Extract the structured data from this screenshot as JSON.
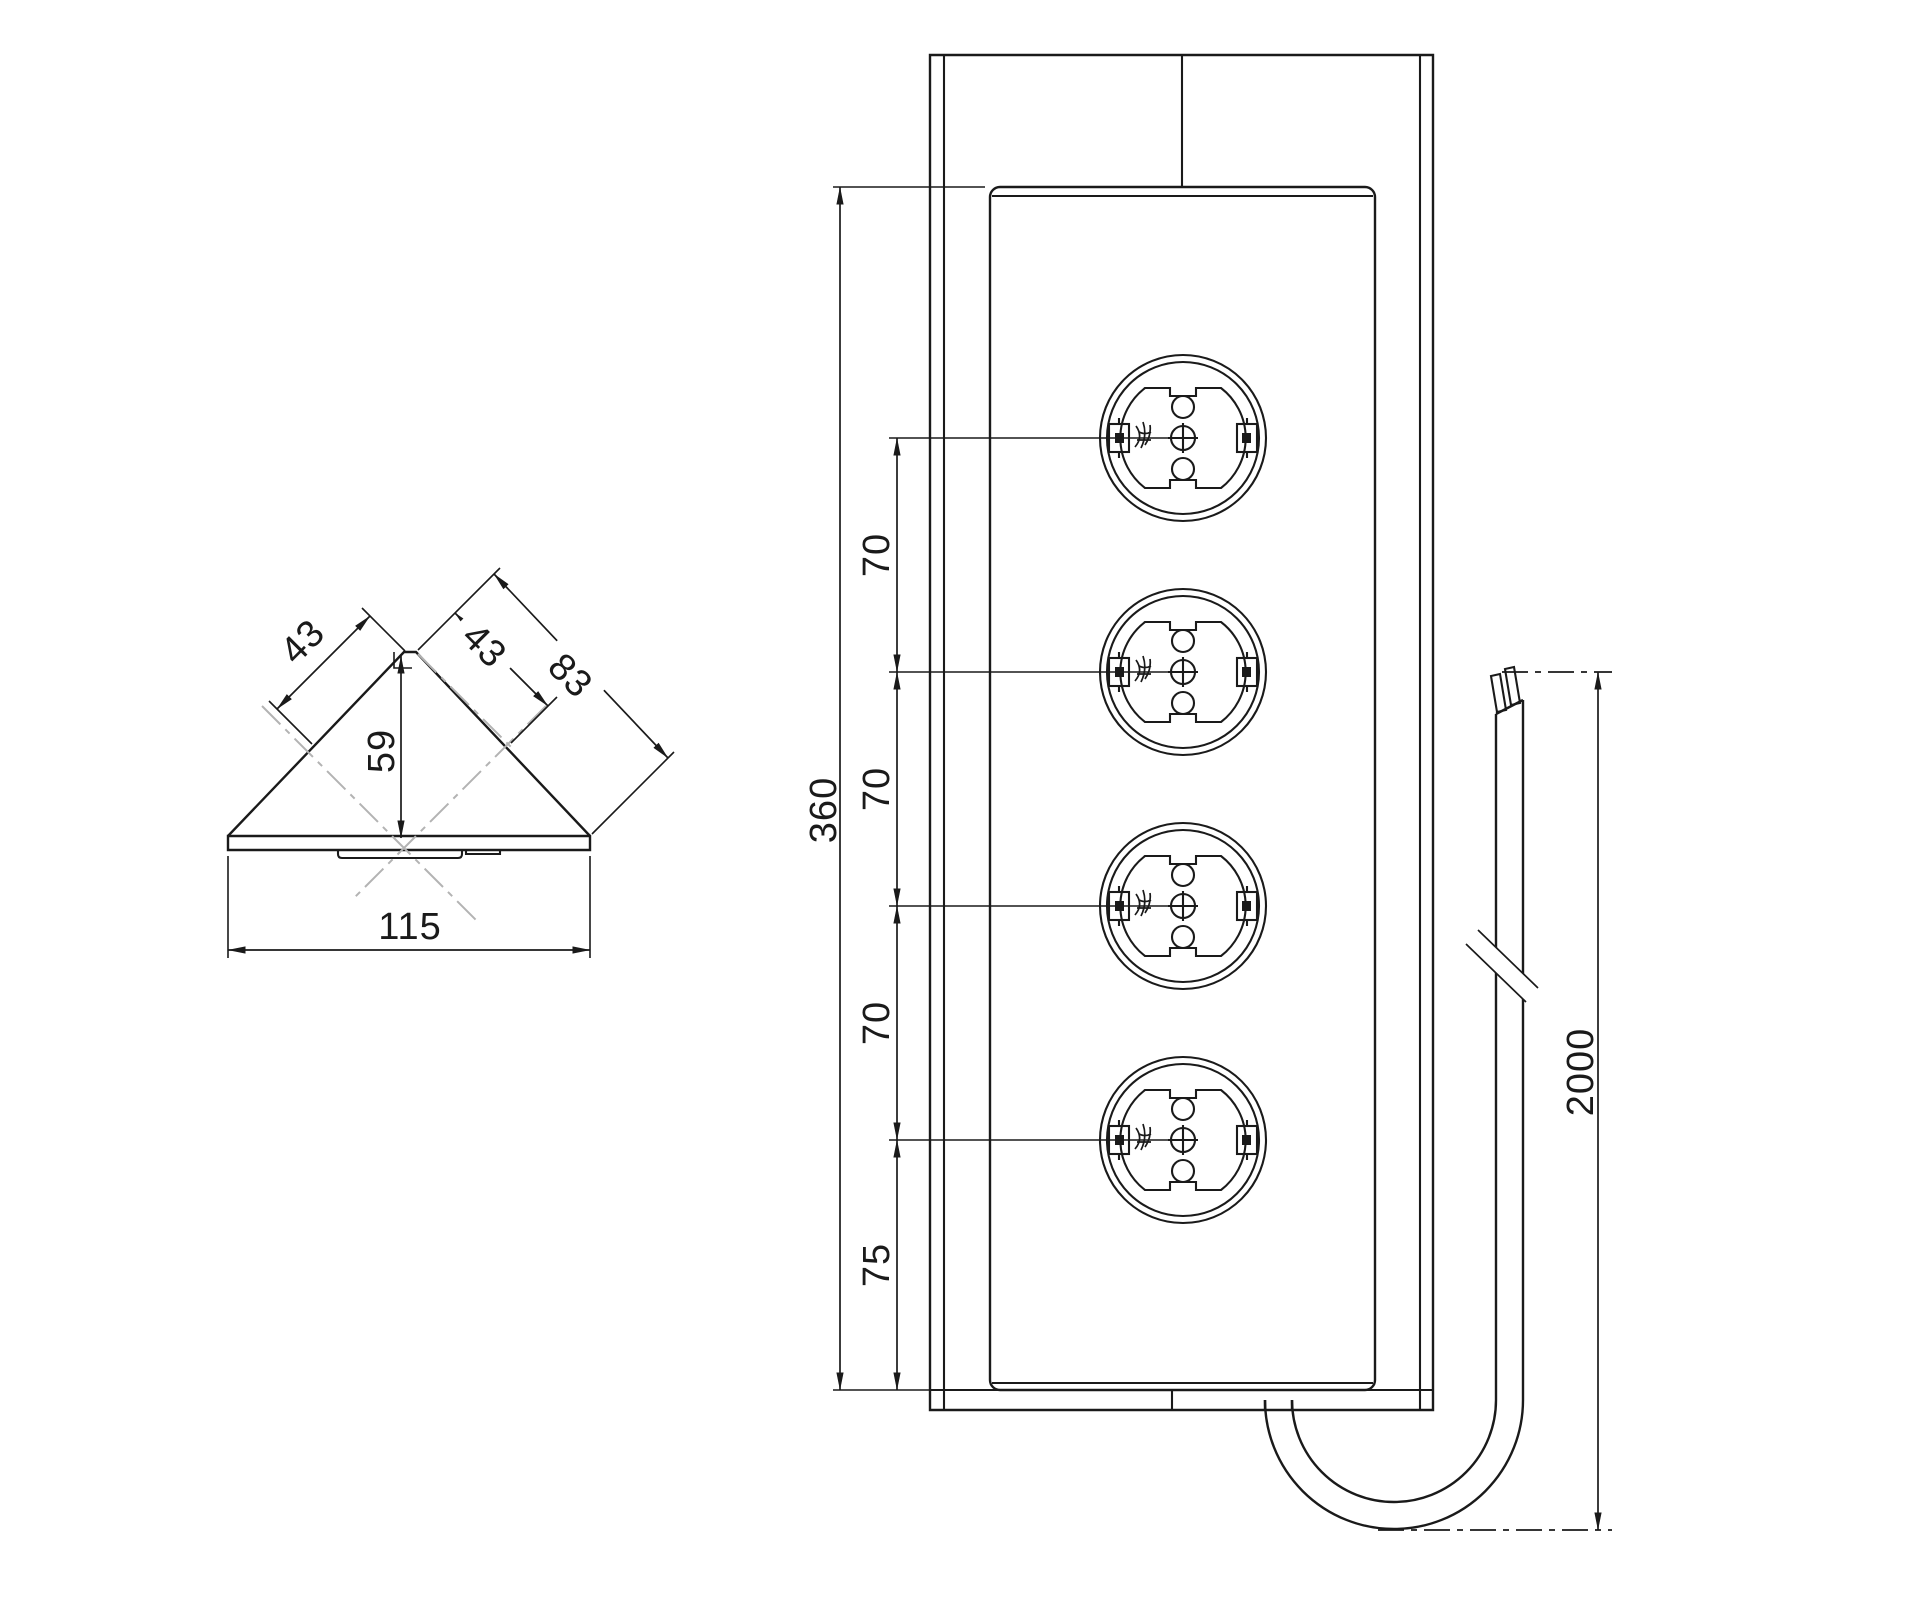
{
  "colors": {
    "line": "#1a1a1a",
    "centerline": "#b3b3b3",
    "background": "#ffffff"
  },
  "side_view": {
    "dims": {
      "face_left": "43",
      "face_right_upper": "43",
      "face_right_full": "83",
      "height": "59",
      "base_width": "115"
    }
  },
  "front_view": {
    "socket_count": 4,
    "dims": {
      "panel_length": "360",
      "socket_spacing_1": "70",
      "socket_spacing_2": "70",
      "socket_spacing_3": "70",
      "bottom_spacing": "75"
    }
  },
  "cable": {
    "dims": {
      "length": "2000"
    }
  }
}
